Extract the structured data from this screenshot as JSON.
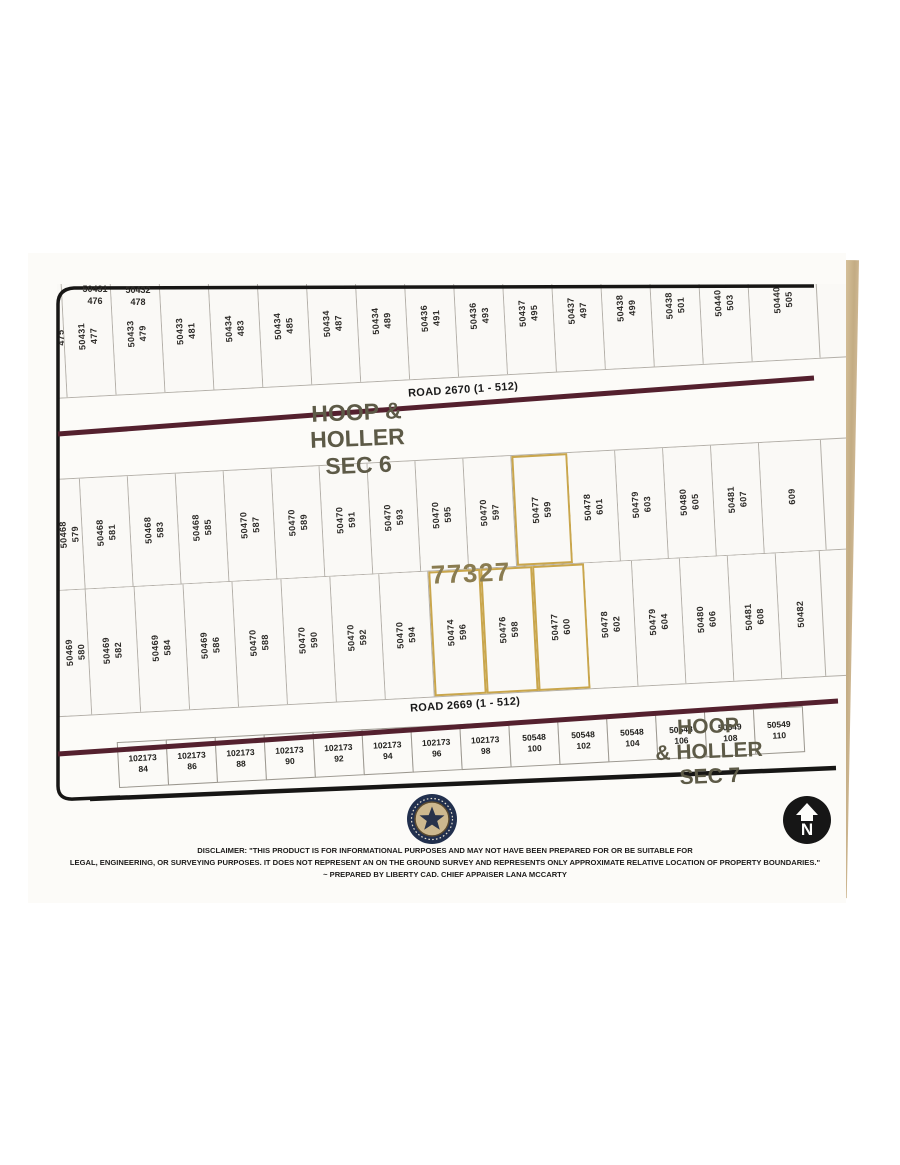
{
  "map": {
    "section6": {
      "lines": [
        "HOOP &",
        "HOLLER",
        "SEC 6"
      ]
    },
    "section7": {
      "lines": [
        "HOOP",
        "& HOLLER",
        "SEC 7"
      ]
    },
    "road_top_label": "ROAD 2670 (1 - 512)",
    "road_bottom_label": "ROAD 2669 (1 - 512)",
    "highlight_number": "77327",
    "top_horizontal_labels": [
      {
        "acct": "50431",
        "lot": "476"
      },
      {
        "acct": "50432",
        "lot": "478"
      }
    ],
    "tier1": [
      {
        "acct": "50431",
        "lot": "475",
        "w": 18
      },
      {
        "acct": "50431",
        "lot": "477",
        "w": 49
      },
      {
        "acct": "50433",
        "lot": "479",
        "w": 49
      },
      {
        "acct": "50433",
        "lot": "481",
        "w": 49
      },
      {
        "acct": "50434",
        "lot": "483",
        "w": 49
      },
      {
        "acct": "50434",
        "lot": "485",
        "w": 49
      },
      {
        "acct": "50434",
        "lot": "487",
        "w": 49
      },
      {
        "acct": "50434",
        "lot": "489",
        "w": 49
      },
      {
        "acct": "50436",
        "lot": "491",
        "w": 49
      },
      {
        "acct": "50436",
        "lot": "493",
        "w": 49
      },
      {
        "acct": "50437",
        "lot": "495",
        "w": 49
      },
      {
        "acct": "50437",
        "lot": "497",
        "w": 49
      },
      {
        "acct": "50438",
        "lot": "499",
        "w": 49
      },
      {
        "acct": "50438",
        "lot": "501",
        "w": 49
      },
      {
        "acct": "50440",
        "lot": "503",
        "w": 49
      },
      {
        "acct": "50440",
        "lot": "505",
        "w": 68
      }
    ],
    "tier2": [
      {
        "acct": "50468",
        "lot": "579",
        "w": 26
      },
      {
        "acct": "50468",
        "lot": "581",
        "w": 48
      },
      {
        "acct": "50468",
        "lot": "583",
        "w": 48
      },
      {
        "acct": "50468",
        "lot": "585",
        "w": 48
      },
      {
        "acct": "50470",
        "lot": "587",
        "w": 48
      },
      {
        "acct": "50470",
        "lot": "589",
        "w": 48
      },
      {
        "acct": "50470",
        "lot": "591",
        "w": 48
      },
      {
        "acct": "50470",
        "lot": "593",
        "w": 48
      },
      {
        "acct": "50470",
        "lot": "595",
        "w": 48
      },
      {
        "acct": "50470",
        "lot": "597",
        "w": 48
      },
      {
        "acct": "50477",
        "lot": "599",
        "w": 56,
        "hl": true
      },
      {
        "acct": "50478",
        "lot": "601",
        "w": 48
      },
      {
        "acct": "50479",
        "lot": "603",
        "w": 48
      },
      {
        "acct": "50480",
        "lot": "605",
        "w": 48
      },
      {
        "acct": "50481",
        "lot": "607",
        "w": 48
      },
      {
        "acct": "",
        "lot": "609",
        "w": 62
      }
    ],
    "tier3": [
      {
        "acct": "50469",
        "lot": "580",
        "w": 26
      },
      {
        "acct": "50469",
        "lot": "582",
        "w": 49
      },
      {
        "acct": "50469",
        "lot": "584",
        "w": 49
      },
      {
        "acct": "50469",
        "lot": "586",
        "w": 49
      },
      {
        "acct": "50470",
        "lot": "588",
        "w": 49
      },
      {
        "acct": "50470",
        "lot": "590",
        "w": 49
      },
      {
        "acct": "50470",
        "lot": "592",
        "w": 49
      },
      {
        "acct": "50470",
        "lot": "594",
        "w": 49
      },
      {
        "acct": "50474",
        "lot": "596",
        "w": 52,
        "hl": true
      },
      {
        "acct": "50476",
        "lot": "598",
        "w": 52,
        "hl": true
      },
      {
        "acct": "50477",
        "lot": "600",
        "w": 52,
        "hl": true
      },
      {
        "acct": "50478",
        "lot": "602",
        "w": 48
      },
      {
        "acct": "50479",
        "lot": "604",
        "w": 48
      },
      {
        "acct": "50480",
        "lot": "606",
        "w": 48
      },
      {
        "acct": "50481",
        "lot": "608",
        "w": 48
      },
      {
        "acct": "50482",
        "lot": "",
        "w": 44
      }
    ],
    "bottom_tier": [
      {
        "acct": "102173",
        "lot": "84",
        "w": 50
      },
      {
        "acct": "102173",
        "lot": "86",
        "w": 50
      },
      {
        "acct": "102173",
        "lot": "88",
        "w": 50
      },
      {
        "acct": "102173",
        "lot": "90",
        "w": 50
      },
      {
        "acct": "102173",
        "lot": "92",
        "w": 50
      },
      {
        "acct": "102173",
        "lot": "94",
        "w": 50
      },
      {
        "acct": "102173",
        "lot": "96",
        "w": 50
      },
      {
        "acct": "102173",
        "lot": "98",
        "w": 50
      },
      {
        "acct": "50548",
        "lot": "100",
        "w": 50
      },
      {
        "acct": "50548",
        "lot": "102",
        "w": 50
      },
      {
        "acct": "50548",
        "lot": "104",
        "w": 50
      },
      {
        "acct": "50548",
        "lot": "106",
        "w": 50
      },
      {
        "acct": "50549",
        "lot": "108",
        "w": 50
      },
      {
        "acct": "50549",
        "lot": "110",
        "w": 50
      }
    ],
    "colors": {
      "road": "#54202e",
      "gold_highlight": "#c9a64c",
      "frame": "#171615",
      "section_text": "#5d5a47",
      "highlight_text": "#8a7c50",
      "paper_edge_tan": "#cdb691"
    }
  },
  "footer": {
    "disclaimer_lines": [
      "DISCLAIMER: \"THIS PRODUCT IS FOR INFORMATIONAL PURPOSES AND MAY NOT HAVE BEEN PREPARED FOR OR BE SUITABLE FOR",
      "LEGAL, ENGINEERING, OR SURVEYING PURPOSES. IT DOES NOT REPRESENT AN ON THE GROUND SURVEY AND REPRESENTS ONLY APPROXIMATE RELATIVE LOCATION OF PROPERTY BOUNDARIES.\"",
      "~ PREPARED BY LIBERTY CAD. CHIEF APPAISER LANA MCCARTY"
    ],
    "north_marker": "N"
  }
}
